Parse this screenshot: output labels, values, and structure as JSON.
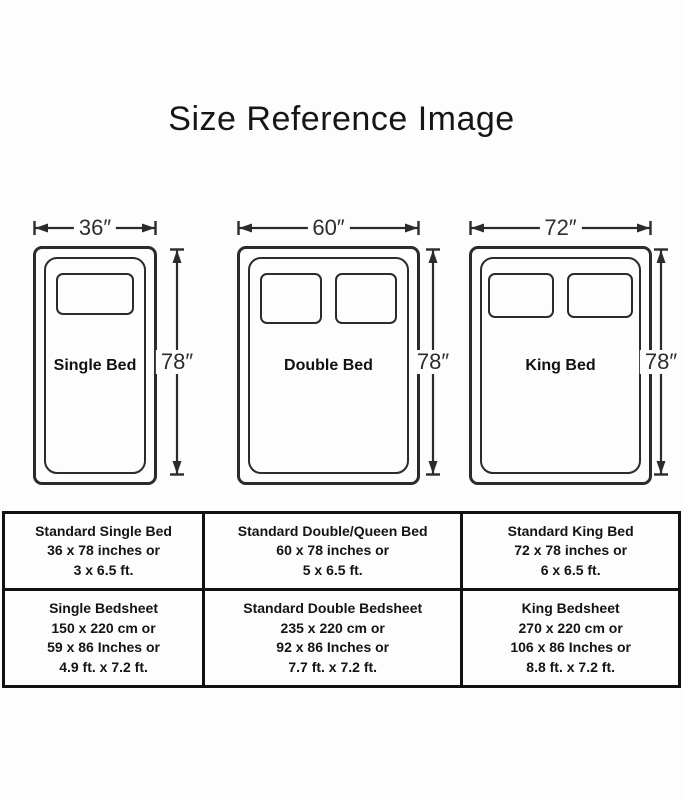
{
  "title": "Size Reference Image",
  "beds": [
    {
      "name": "Single Bed",
      "width_label": "36″",
      "height_label": "78″"
    },
    {
      "name": "Double Bed",
      "width_label": "60″",
      "height_label": "78″"
    },
    {
      "name": "King Bed",
      "width_label": "72″",
      "height_label": "78″"
    }
  ],
  "table": {
    "rows": [
      {
        "cells": [
          {
            "lines": [
              "Standard Single Bed",
              "36 x 78 inches or",
              "3 x 6.5 ft."
            ]
          },
          {
            "lines": [
              "Standard Double/Queen Bed",
              "60 x 78 inches or",
              "5 x 6.5 ft."
            ]
          },
          {
            "lines": [
              "Standard King Bed",
              "72 x 78 inches or",
              "6 x 6.5 ft."
            ]
          }
        ]
      },
      {
        "cells": [
          {
            "lines": [
              "Single Bedsheet",
              "150 x 220 cm or",
              "59 x 86 Inches or",
              "4.9 ft. x 7.2 ft."
            ]
          },
          {
            "lines": [
              "Standard Double Bedsheet",
              "235 x 220 cm or",
              "92 x 86 Inches or",
              "7.7 ft. x 7.2 ft."
            ]
          },
          {
            "lines": [
              "King Bedsheet",
              "270 x 220 cm or",
              "106 x 86 Inches or",
              "8.8 ft. x 7.2 ft."
            ]
          }
        ]
      }
    ]
  },
  "colors": {
    "ink": "#2b2b2b",
    "table_border": "#111111",
    "background": "#fdfdfd"
  }
}
